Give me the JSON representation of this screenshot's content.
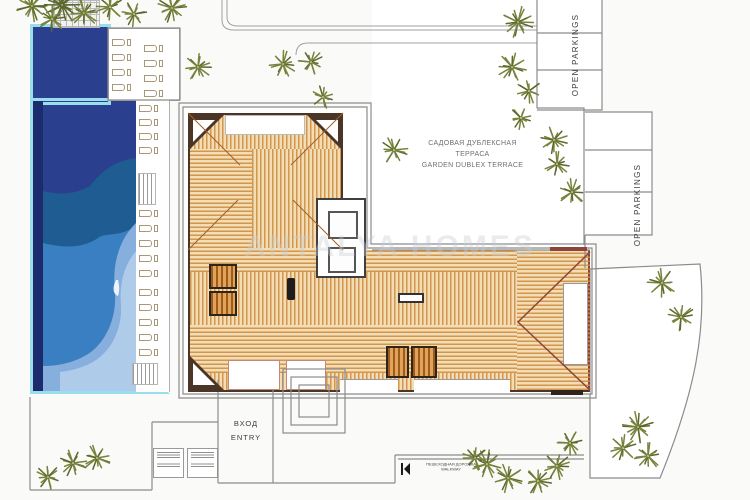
{
  "labels": {
    "garden_terrace_ru1": "САДОВАЯ ДУБЛЕКСНАЯ",
    "garden_terrace_ru2": "ТЕРРАСА",
    "garden_terrace_en": "GARDEN DUBLEX TERRACE",
    "open_parkings_top": "OPEN PARKINGS",
    "open_parkings_right": "OPEN PARKINGS",
    "entry_ru": "ВХОД",
    "entry_en": "ENTRY",
    "walkway_ru": "ПЕШЕХОДНАЯ ДОРОЖКА",
    "walkway_en": "WALKWAY",
    "watermark": "ANTALYA HOMES"
  },
  "colors": {
    "background": "#fafaf8",
    "line": "#8c8c8c",
    "pool_border": "#9adeee",
    "pool_edge_dark": "#1c2a6e",
    "pool_navy": "#2a3f8e",
    "pool_deep": "#1e5c91",
    "pool_mid": "#3a7fc1",
    "pool_light": "#86afdd",
    "pool_pale": "#aecbe9",
    "roof_base": "#f2ddb4",
    "roof_stripe": "#cd8a3c",
    "roof_border": "#4a3526",
    "wing_accent": "#8e4438",
    "stair_base": "#e2a258",
    "stair_stripe": "#9c5c1e",
    "tree_green": "#76833b",
    "tree_dark": "#5b682c",
    "text_gray": "#6f6f6f",
    "text_dark": "#3c3c3c",
    "watermark_gray": "#c8cdd5"
  },
  "trees": [
    [
      32,
      6,
      15
    ],
    [
      62,
      5,
      17,
      1
    ],
    [
      52,
      19,
      13
    ],
    [
      84,
      13,
      14
    ],
    [
      110,
      7,
      13
    ],
    [
      134,
      14,
      12
    ],
    [
      172,
      8,
      14
    ],
    [
      198,
      67,
      13
    ],
    [
      283,
      64,
      13
    ],
    [
      311,
      62,
      12
    ],
    [
      323,
      97,
      11
    ],
    [
      394,
      150,
      13
    ],
    [
      518,
      22,
      15
    ],
    [
      512,
      67,
      14
    ],
    [
      529,
      91,
      12
    ],
    [
      521,
      118,
      11
    ],
    [
      554,
      140,
      13
    ],
    [
      557,
      164,
      12
    ],
    [
      572,
      192,
      13
    ],
    [
      662,
      283,
      14
    ],
    [
      681,
      317,
      13
    ],
    [
      638,
      427,
      15
    ],
    [
      623,
      448,
      13
    ],
    [
      648,
      456,
      13
    ],
    [
      570,
      443,
      12
    ],
    [
      557,
      466,
      13
    ],
    [
      538,
      481,
      13
    ],
    [
      508,
      478,
      14
    ],
    [
      487,
      464,
      14
    ],
    [
      475,
      458,
      12
    ],
    [
      48,
      477,
      12
    ],
    [
      73,
      463,
      13
    ],
    [
      97,
      458,
      13
    ]
  ],
  "loungers": {
    "groups": [
      {
        "x": 112,
        "y": 39,
        "n": 4,
        "dy": 15
      },
      {
        "x": 144,
        "y": 45,
        "n": 4,
        "dy": 15
      },
      {
        "x": 139,
        "y": 105,
        "n": 4,
        "dy": 14
      },
      {
        "x": 139,
        "y": 210,
        "n": 5,
        "dy": 15
      },
      {
        "x": 139,
        "y": 289,
        "n": 5,
        "dy": 15
      }
    ]
  }
}
